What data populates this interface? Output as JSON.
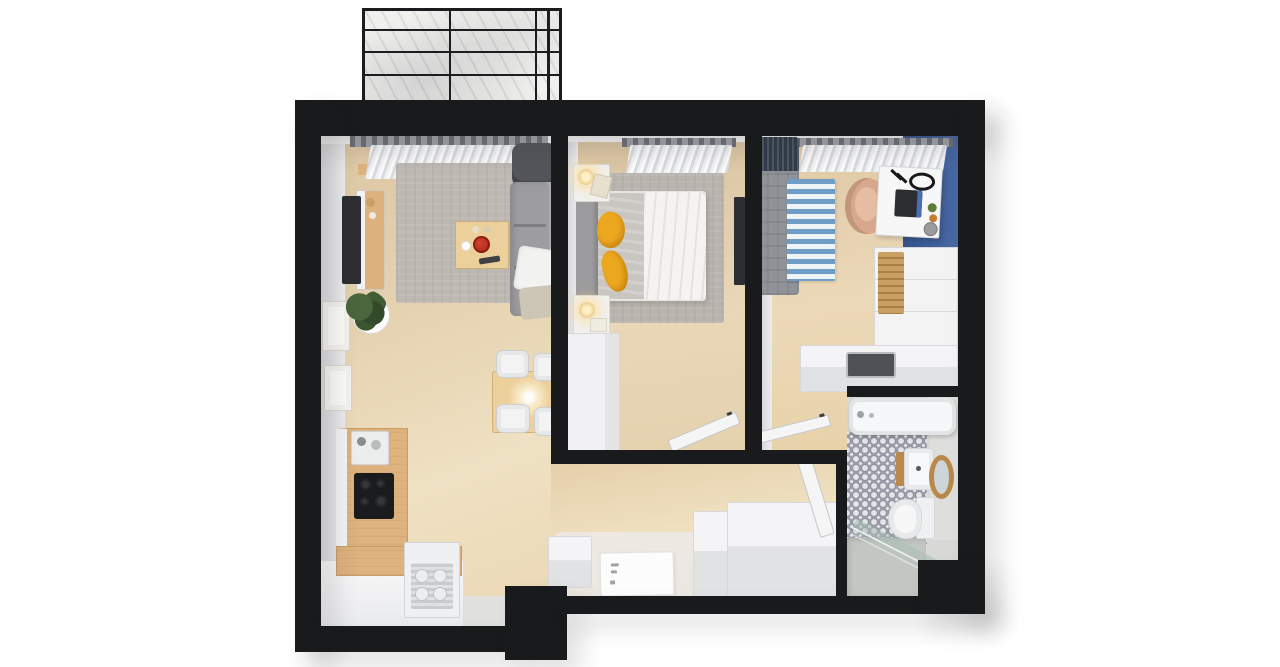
{
  "meta": {
    "title": "3D top-down floor plan render of a two-bedroom apartment with balcony",
    "view": "bird's-eye 3d render",
    "background": "#ffffff"
  },
  "palette": {
    "wall": "#191a1b",
    "wood": "#e4cea9",
    "wood_furn": "#ddb27e",
    "table_wood": "#ecd09b",
    "wall_face": "#e4e4e6",
    "rug": "#bdb8b2",
    "sofa": "#9d9da0",
    "armchair": "#54555a",
    "blue": "#3f5f9b",
    "rug_blue": "#6f9dc6",
    "kids_bed": "#8f9398",
    "navy": "#323c4a",
    "chair_tan": "#d8a88c",
    "yellow": "#eca81f",
    "red": "#b12a1c",
    "white_furn": "#f4f4f6",
    "furn_face": "#e1e2e4",
    "bath_floor": "#d8d8d6",
    "shower": "#c3c7c3",
    "mirror_wood": "#b9884a",
    "black_appliance": "#1a1b1d",
    "balcony": "#f0f0ee",
    "entry": "#ece9e4",
    "duvet": "#f4f3f1",
    "blanket": "#c9c6c2",
    "headboard": "#9b9b9d",
    "art": "#2d2e31"
  },
  "rooms": [
    {
      "name": "balcony",
      "items": [
        "wireframe-railing",
        "concrete-floor"
      ]
    },
    {
      "name": "living-room",
      "items": [
        "gray-sofa",
        "dark-armchair",
        "white-pillow",
        "throw-blanket",
        "coffee-table",
        "red-bowl",
        "remote",
        "tv",
        "tv-sideboard",
        "potted-plant",
        "wall-frame",
        "wall-frame",
        "area-rug",
        "dining-table",
        "pendant-light",
        "dining-chair",
        "dining-chair",
        "dining-chair",
        "dining-chair",
        "window-curtain"
      ]
    },
    {
      "name": "kitchen",
      "items": [
        "l-shaped-counter",
        "cooktop",
        "coffee-machine",
        "dishwasher-open",
        "dish-rack"
      ]
    },
    {
      "name": "bedroom",
      "items": [
        "double-bed",
        "gray-headboard",
        "white-duvet",
        "gray-blanket",
        "yellow-throw",
        "yellow-throw",
        "nightstand",
        "nightstand",
        "table-lamp",
        "table-lamp",
        "area-rug",
        "wardrobe",
        "wall-art",
        "window-curtain",
        "open-door"
      ]
    },
    {
      "name": "kids-room",
      "items": [
        "single-bed",
        "navy-pillow",
        "striped-rug",
        "desk",
        "monitor",
        "desk-lamp",
        "shell-chair",
        "dresser",
        "wood-slat-panel",
        "low-cabinet",
        "blue-accent-wall",
        "ceiling-vent",
        "window-curtain",
        "open-door"
      ]
    },
    {
      "name": "hallway",
      "items": [
        "tall-wardrobe",
        "cabinet",
        "low-cabinet",
        "doormat",
        "entry-area",
        "bathroom-door"
      ]
    },
    {
      "name": "bathroom",
      "items": [
        "bathtub",
        "patterned-tile-floor",
        "washbasin",
        "round-mirror",
        "toilet",
        "shower-glass-panel",
        "shower-floor"
      ]
    }
  ]
}
